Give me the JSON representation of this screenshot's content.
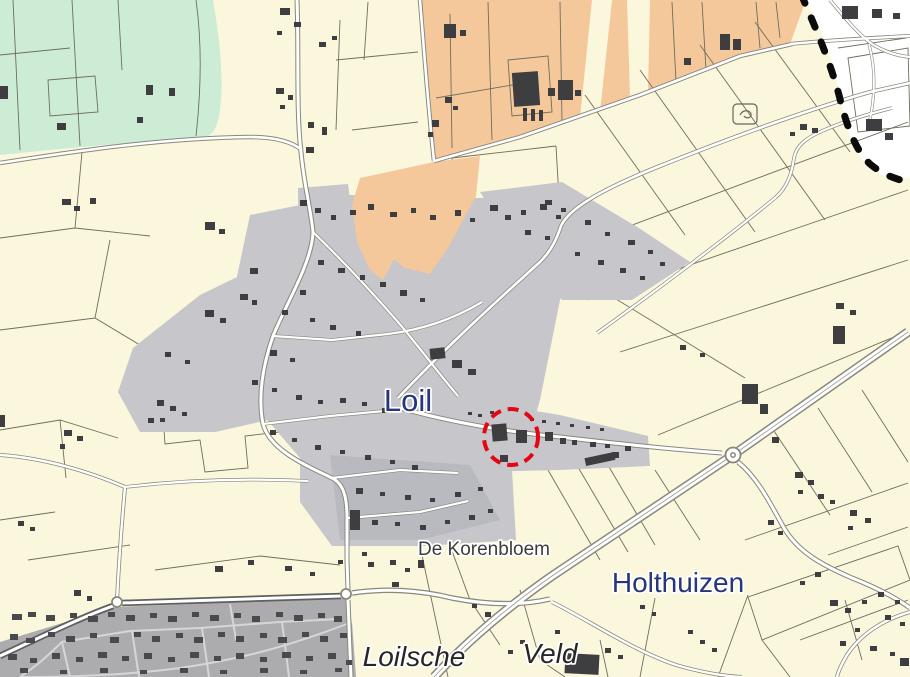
{
  "map": {
    "type": "topographic-cadastral-map",
    "labels": {
      "village": "Loil",
      "farm": "De Korenbloem",
      "hamlet": "Holthuizen",
      "field_area_word1": "Loilsche",
      "field_area_word2": "Veld"
    },
    "colors": {
      "background": "#fbf7dc",
      "field_green": "#cdecd6",
      "field_orange": "#f5c89b",
      "builtup_gray": "#c6c6cb",
      "builtup_gray_dark": "#b9b9c0",
      "urban_gray": "#acacaf",
      "adjacent_municipality_white": "#ffffff",
      "building_dark": "#3e3e40",
      "urban_building": "#4a4a4c",
      "road_fill": "#ffffff",
      "road_casing": "#88887d",
      "road_casing_dark": "#5f5f5f",
      "parcel_line": "#6e6e5e",
      "municipal_boundary": "#0b0b0b",
      "highlight_red": "#e30613",
      "place_label_blue": "#27357f",
      "minor_label_gray": "#3c3c3c",
      "field_label_dark": "#262626"
    },
    "annotations": {
      "highlight_circle": {
        "shape": "dashed-ellipse",
        "center_x": 511,
        "center_y": 437,
        "radius_x": 27,
        "radius_y": 28
      }
    }
  }
}
